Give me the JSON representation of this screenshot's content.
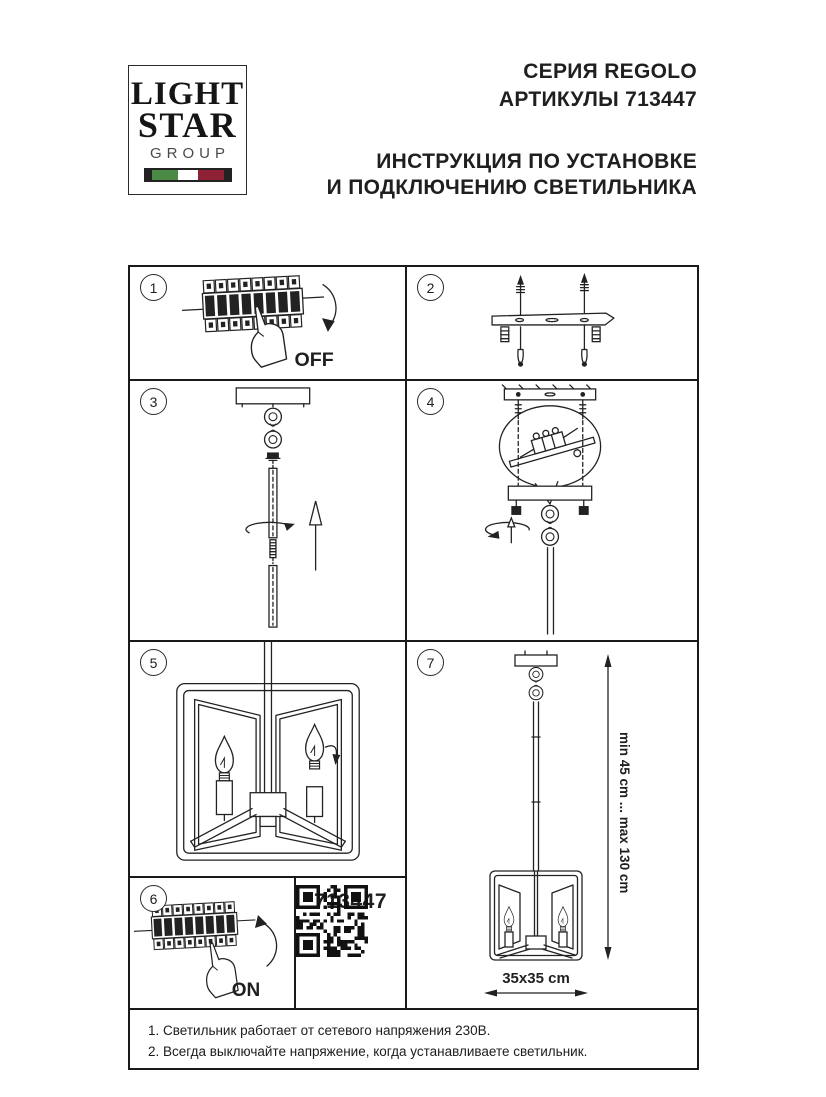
{
  "header": {
    "logo": {
      "line1": "LIGHT",
      "line2": "STAR",
      "line3": "GROUP"
    },
    "series": "СЕРИЯ REGOLO",
    "articles": "АРТИКУЛЫ 713447",
    "instruction_line1": "ИНСТРУКЦИЯ ПО УСТАНОВКЕ",
    "instruction_line2": "И ПОДКЛЮЧЕНИЮ СВЕТИЛЬНИКА"
  },
  "colors": {
    "ink": "#1f1f1f",
    "flag_green": "#4a8a44",
    "flag_white": "#ffffff",
    "flag_red": "#8e2133"
  },
  "steps": {
    "s1": {
      "number": "1",
      "switch_label": "OFF"
    },
    "s2": {
      "number": "2"
    },
    "s3": {
      "number": "3"
    },
    "s4": {
      "number": "4"
    },
    "s5": {
      "number": "5"
    },
    "s6": {
      "number": "6",
      "switch_label": "ON"
    },
    "s7": {
      "number": "7",
      "height_range": "min 45 cm ... max 130 cm",
      "base_size": "35x35 cm"
    }
  },
  "qr_block": {
    "article_number": "713447"
  },
  "footer": {
    "notes": [
      "1. Светильник работает от сетевого напряжения 230В.",
      "2. Всегда выключайте напряжение, когда устанавливаете светильник."
    ]
  }
}
